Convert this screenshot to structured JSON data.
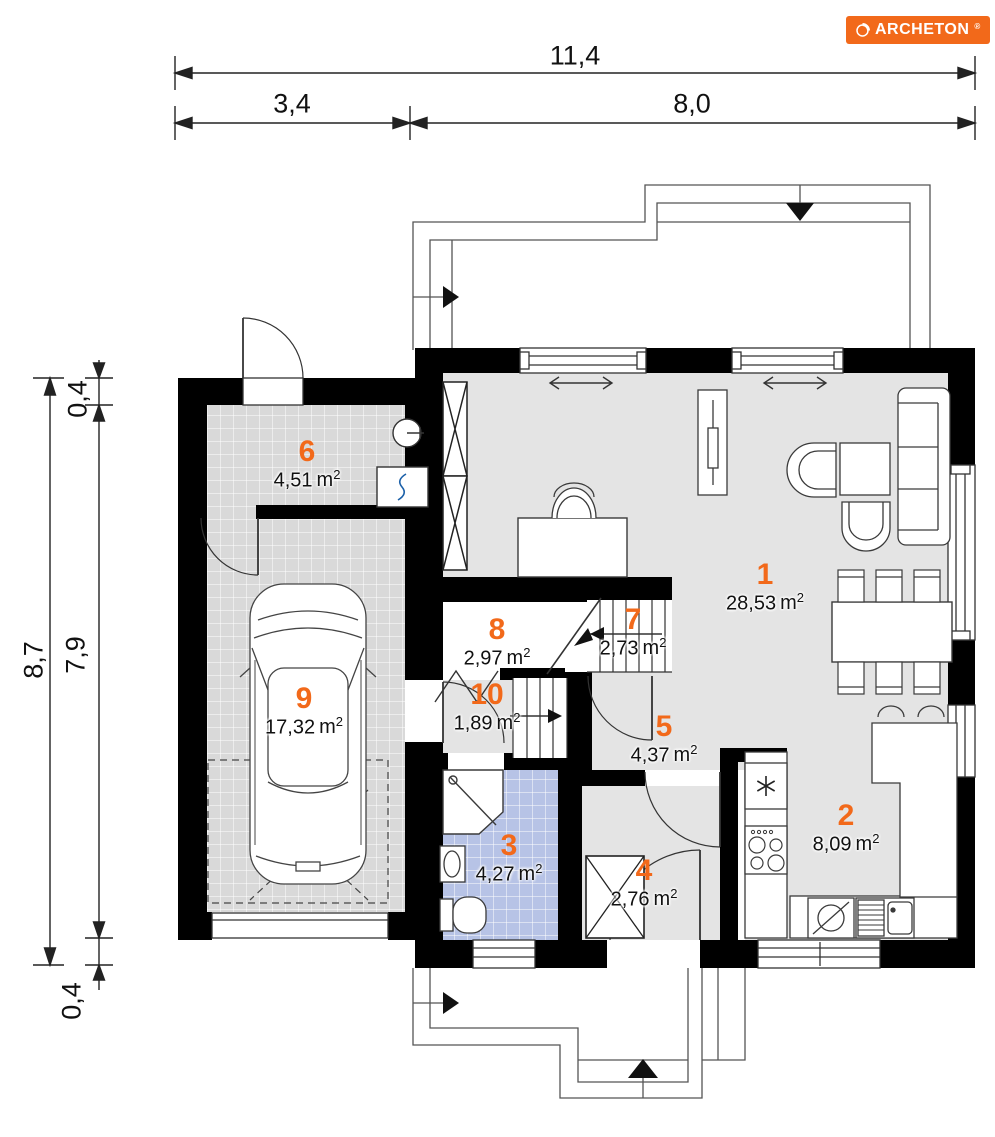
{
  "logo": {
    "text": "ARCHETON",
    "reg": "®"
  },
  "units": {
    "base": "m",
    "exp": "2"
  },
  "colors": {
    "accent": "#f2691a",
    "wall": "#000000",
    "floor_gray": "#e4e4e4",
    "tile_gray": "#d9d9d9",
    "tile_blue": "#b7c3e6"
  },
  "dimensions": {
    "top_total": "11,4",
    "top_left": "3,4",
    "top_right": "8,0",
    "side_total": "8,7",
    "side_top": "0,4",
    "side_middle": "7,9",
    "side_bottom": "0,4"
  },
  "rooms": [
    {
      "number": "1",
      "area": "28,53"
    },
    {
      "number": "2",
      "area": "8,09"
    },
    {
      "number": "3",
      "area": "4,27"
    },
    {
      "number": "4",
      "area": "2,76"
    },
    {
      "number": "5",
      "area": "4,37"
    },
    {
      "number": "6",
      "area": "4,51"
    },
    {
      "number": "7",
      "area": "2,73"
    },
    {
      "number": "8",
      "area": "2,97"
    },
    {
      "number": "9",
      "area": "17,32"
    },
    {
      "number": "10",
      "area": "1,89"
    }
  ]
}
